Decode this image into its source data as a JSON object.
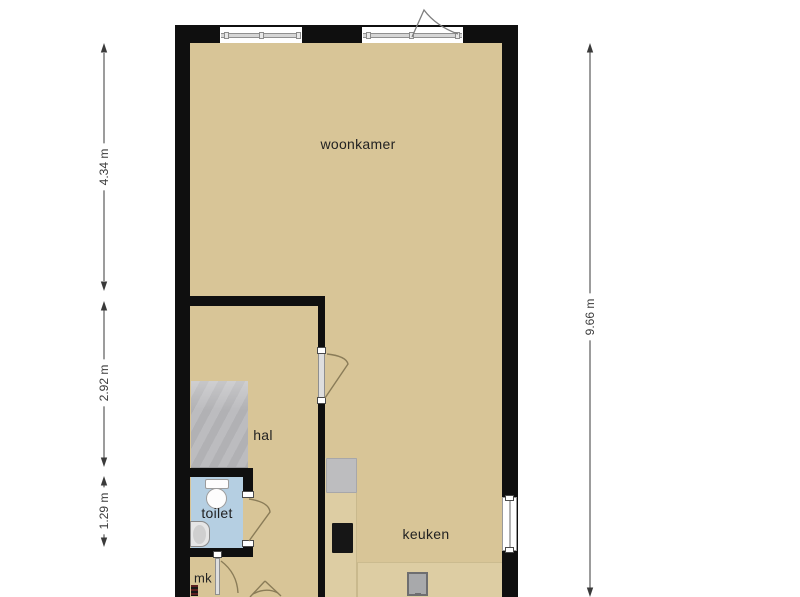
{
  "rooms": {
    "woonkamer": "woonkamer",
    "hal": "hal",
    "toilet": "toilet",
    "keuken": "keuken",
    "mk": "mk"
  },
  "dimensions": {
    "left_top": "4.34 m",
    "left_middle": "2.92 m",
    "left_bottom": "1.29 m",
    "right": "9.66 m"
  },
  "colors": {
    "background": "#ffffff",
    "wall": "#0f0f0f",
    "floor": "#d8c597",
    "toilet_floor": "#b5cfe2",
    "stairs": "#b8b8bb",
    "counter": "#ddcda3",
    "appliance": "#bdbdbf",
    "cooktop": "#161616",
    "sink": "#a8a9ab",
    "door_arc": "#8a7c58",
    "dimension": "#3a3a3a",
    "label_text": "#222222"
  }
}
